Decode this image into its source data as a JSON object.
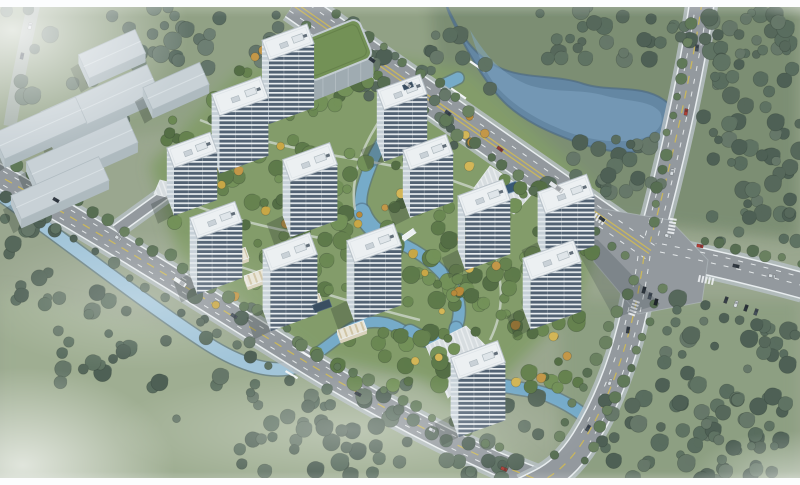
{
  "scene_title": "aerial-masterplan-rendering",
  "palette": {
    "base_grass": "#95a288",
    "asphalt": "#8d9398",
    "asphalt_hazy": "#a6aeb4",
    "sidewalk": "#b3bbc0",
    "curb": "#e9edef",
    "lane_yellow": "#cdb64a",
    "lane_white": "#eceff1",
    "lake": "#5b7f9e",
    "lake_light": "#7ba4c2",
    "water_edge": "#44627c",
    "canal_inner": "#6ea6c6",
    "canal_outer": "#9ec2d8",
    "roof_white": "#edf0f3",
    "roof_edge": "#b6bfc6",
    "warehouse_roof": "#c6cfd4",
    "warehouse_wall": "#aab6bc",
    "green_roof": "#6b8a4b",
    "green_roof_wall": "#9aa6ad",
    "shadow": "rgba(22,32,27,0.27)",
    "pool": "#2c4d6c"
  },
  "tree_palettes": {
    "F": [
      "#4c5e50",
      "#566a59",
      "#43564a",
      "#5d6f5f",
      "#4f6354"
    ],
    "FC": [
      "#5a6c60",
      "#4e6156",
      "#65776a"
    ],
    "I": [
      "#54713e",
      "#628047",
      "#4a6538",
      "#6b8a4e",
      "#5d7a43"
    ],
    "A": [
      "#c6a23a",
      "#d2b24c",
      "#b5832e",
      "#c1913c"
    ],
    "S": [
      "#57704e",
      "#4d6546",
      "#617956"
    ]
  },
  "fields": [
    {
      "pts": "0,0 800,0 800,165 430,150 260,120 0,150",
      "c": "#8b9b7d"
    },
    {
      "pts": "430,0 800,0 800,240 600,220 440,120",
      "c": "#74876a"
    },
    {
      "pts": "150,165 235,75 300,45 470,70 610,200 580,300 470,410 330,370 180,260",
      "c": "#7b9660"
    },
    {
      "pts": "0,290 420,380 560,485 0,485",
      "c": "#9aa98b"
    },
    {
      "pts": "560,300 800,300 800,485 560,485",
      "c": "#87997a"
    }
  ],
  "lake": {
    "body": "M446,4 C458,30 470,52 496,66 C522,80 556,74 584,84 C610,92 642,84 664,100 C684,114 688,134 668,144 C640,158 604,152 576,142 C548,132 522,120 504,102 C486,84 470,56 458,32 C452,20 448,12 446,4 Z",
    "highlight": "M470,30 C486,56 502,74 526,84 C552,94 580,88 606,96 C630,102 650,100 660,112 C666,124 656,136 636,140 C608,144 580,138 558,128 C534,118 512,104 498,88 C484,72 476,50 470,30 Z"
  },
  "canals": [
    {
      "d": "M-6,190 C60,236 140,300 208,344 C246,368 276,374 298,366",
      "w": 12,
      "c": "#9ec2d8"
    },
    {
      "d": "M298,366 C318,354 332,342 346,332 C362,320 382,318 402,330",
      "w": 10,
      "c": "#6ea6c6"
    },
    {
      "d": "M458,78 C434,90 414,96 403,112 C390,130 378,146 371,164 C364,182 358,198 362,212",
      "w": 11,
      "c": "#6ea6c6"
    },
    {
      "d": "M362,212 C368,228 382,238 398,242",
      "w": 16,
      "c": "#6ea6c6"
    },
    {
      "d": "M398,242 C420,252 436,264 448,280 C460,296 462,312 456,328",
      "w": 11,
      "c": "#6ea6c6"
    },
    {
      "d": "M456,328 C450,350 462,370 486,380 C510,390 532,388 550,396 C564,402 574,408 582,414",
      "w": 12,
      "c": "#6ea6c6"
    },
    {
      "d": "M410,332 C424,340 436,344 448,342",
      "w": 14,
      "c": "#6ea6c6"
    }
  ],
  "roads": [
    {
      "id": "hazy-northwest-road",
      "d": "M36,-6 C26,40 16,86 10,126",
      "w": 13,
      "hazy": true
    },
    {
      "id": "perimeter-south-road",
      "d": "M-8,172 C90,226 200,296 306,362 C378,406 440,438 498,464 C520,473 536,479 548,484",
      "w": 21
    },
    {
      "id": "east-exit-road",
      "d": "M660,252 C710,262 760,274 804,286",
      "w": 24
    },
    {
      "id": "north-vertical-road",
      "d": "M702,2 C690,84 668,176 650,242",
      "w": 23
    },
    {
      "id": "south-vertical-road",
      "d": "M644,256 C634,330 614,392 584,440 C570,462 556,474 540,482 L524,490",
      "w": 24
    },
    {
      "id": "main-diagonal-road",
      "d": "M294,4 L650,252",
      "w": 29
    },
    {
      "id": "west-gate-branch",
      "d": "M116,230 L174,188",
      "w": 9
    }
  ],
  "junction": {
    "pts": "585,206 670,220 708,260 702,302 638,314 594,262",
    "shadow_pts": "568,234 598,240 660,304 614,318"
  },
  "lane_marks": [
    {
      "d": "M293,5.5 L649,253.5",
      "t": "ys"
    },
    {
      "d": "M295,2.5 L651,250.5",
      "t": "ys"
    },
    {
      "d": "M289.4,10.6 L645.4,258.6",
      "t": "wd"
    },
    {
      "d": "M298.6,-2.6 L654.6,245.4",
      "t": "wd"
    },
    {
      "d": "M702,2 C690,84 668,176 650,242",
      "t": "yd"
    },
    {
      "d": "M696,2 C684,84 662,176 644,240",
      "t": "wd"
    },
    {
      "d": "M708,2 C696,84 674,176 656,244",
      "t": "wd"
    },
    {
      "d": "M644,256 C634,330 614,392 584,440 C570,462 556,474 540,482",
      "t": "yd"
    },
    {
      "d": "M638,256 C628,330 608,390 578,438",
      "t": "wd"
    },
    {
      "d": "M650,256 C640,330 620,394 590,442",
      "t": "wd"
    },
    {
      "d": "M-8,172 C90,226 200,296 306,362 C378,406 440,438 498,464 C520,473 536,479 548,484",
      "t": "yd"
    },
    {
      "d": "M-8,179 C90,233 200,303 306,369 C378,413 438,443 496,469",
      "t": "wd"
    },
    {
      "d": "M-8,165 C90,219 200,289 306,355 C378,399 442,431 500,457",
      "t": "wd"
    },
    {
      "d": "M660,252 C710,262 760,274 804,286",
      "t": "wd"
    },
    {
      "d": "M662,244 C712,254 762,266 804,278",
      "t": "wd"
    }
  ],
  "crosswalks": [
    {
      "x": 598,
      "y": 218,
      "a": 35
    },
    {
      "x": 672,
      "y": 226,
      "a": -80
    },
    {
      "x": 706,
      "y": 280,
      "a": 12
    },
    {
      "x": 634,
      "y": 308,
      "a": -70
    }
  ],
  "walkways": [
    "M200,120 C250,140 300,150 360,160 C420,170 460,180 500,200",
    "M180,200 C230,220 280,230 330,240",
    "M220,260 C280,280 340,300 420,320",
    "M480,230 C500,260 510,300 490,340",
    "M380,120 C360,150 350,180 355,210"
  ],
  "plazas": [
    {
      "pts": "490,166 532,194 514,214 474,188"
    },
    {
      "pts": "426,346 466,326 492,352 448,398"
    },
    {
      "pts": "160,180 184,186 178,200 154,194"
    }
  ],
  "pool": {
    "x": 505,
    "y": 190,
    "w": 26,
    "d": 9,
    "a": -20
  },
  "bridges": [
    {
      "kind": "road",
      "x": 468,
      "y": 80,
      "a": 35,
      "len": 18,
      "w": 31
    },
    {
      "kind": "road",
      "x": 298,
      "y": 364,
      "a": 31,
      "len": 14,
      "w": 23
    },
    {
      "kind": "ped",
      "x": 404,
      "y": 238,
      "a": -35,
      "len": 26,
      "w": 5
    },
    {
      "kind": "ped",
      "x": 348,
      "y": 331,
      "a": -25,
      "len": 18,
      "w": 4
    }
  ],
  "tree_regions": [
    [
      150,
      6,
      140,
      66,
      26,
      "FC"
    ],
    [
      345,
      16,
      95,
      84,
      22,
      "F"
    ],
    [
      535,
      6,
      255,
      54,
      55,
      "F"
    ],
    [
      700,
      52,
      100,
      165,
      48,
      "F"
    ],
    [
      545,
      136,
      118,
      62,
      26,
      "F"
    ],
    [
      432,
      28,
      60,
      120,
      14,
      "F"
    ],
    [
      708,
      212,
      92,
      34,
      10,
      "F"
    ],
    [
      660,
      298,
      140,
      182,
      52,
      "F"
    ],
    [
      600,
      393,
      200,
      88,
      42,
      "F"
    ],
    [
      238,
      383,
      305,
      96,
      68,
      "F"
    ],
    [
      58,
      288,
      195,
      132,
      34,
      "F"
    ],
    [
      0,
      178,
      66,
      132,
      16,
      "F"
    ],
    [
      0,
      6,
      145,
      150,
      20,
      "FC"
    ],
    [
      165,
      92,
      152,
      142,
      38,
      "I"
    ],
    [
      248,
      138,
      205,
      152,
      52,
      "I"
    ],
    [
      378,
      178,
      165,
      132,
      38,
      "I"
    ],
    [
      428,
      278,
      155,
      112,
      38,
      "I"
    ],
    [
      238,
      58,
      155,
      72,
      24,
      "I"
    ],
    [
      488,
      198,
      112,
      92,
      20,
      "I"
    ],
    [
      310,
      328,
      150,
      58,
      18,
      "I"
    ],
    [
      178,
      108,
      310,
      205,
      30,
      "A"
    ],
    [
      398,
      248,
      175,
      142,
      18,
      "A"
    ],
    [
      255,
      35,
      120,
      50,
      8,
      "A"
    ]
  ],
  "tree_lines": [
    [
      20,
      166,
      300,
      340,
      20,
      "S"
    ],
    [
      302,
      346,
      500,
      450,
      13,
      "S"
    ],
    [
      6,
      196,
      288,
      378,
      17,
      "F"
    ],
    [
      304,
      26,
      628,
      254,
      22,
      "S"
    ],
    [
      336,
      14,
      470,
      110,
      9,
      "S"
    ],
    [
      688,
      26,
      652,
      224,
      12,
      "S"
    ],
    [
      634,
      280,
      552,
      454,
      12,
      "S"
    ],
    [
      662,
      290,
      588,
      460,
      12,
      "S"
    ],
    [
      702,
      240,
      800,
      262,
      7,
      "S"
    ]
  ],
  "warehouses": [
    [
      112,
      54,
      62,
      26,
      9
    ],
    [
      100,
      102,
      116,
      30,
      10
    ],
    [
      176,
      86,
      62,
      24,
      9
    ],
    [
      40,
      128,
      90,
      28,
      9
    ],
    [
      82,
      152,
      110,
      28,
      10
    ],
    [
      60,
      188,
      96,
      26,
      9
    ]
  ],
  "green_roof_building": {
    "x": 334,
    "y": 50,
    "w": 68,
    "d": 42,
    "a": -22,
    "h": 20
  },
  "towers": [
    [
      288,
      42,
      48,
      21,
      64
    ],
    [
      402,
      92,
      46,
      21,
      52
    ],
    [
      240,
      96,
      52,
      23,
      58
    ],
    [
      192,
      150,
      46,
      21,
      48
    ],
    [
      428,
      152,
      46,
      21,
      48
    ],
    [
      310,
      162,
      50,
      23,
      56
    ],
    [
      566,
      194,
      52,
      23,
      50
    ],
    [
      484,
      198,
      48,
      22,
      54
    ],
    [
      216,
      220,
      48,
      22,
      56
    ],
    [
      374,
      243,
      50,
      23,
      60
    ],
    [
      290,
      252,
      50,
      23,
      60
    ],
    [
      552,
      260,
      54,
      23,
      50
    ],
    [
      478,
      360,
      50,
      23,
      58
    ]
  ],
  "tower_angle": -20,
  "retail_strips": [
    [
      232,
      258,
      32,
      11
    ],
    [
      260,
      276,
      30,
      11
    ],
    [
      306,
      304,
      32,
      11
    ],
    [
      352,
      330,
      28,
      10
    ],
    [
      470,
      404,
      34,
      11
    ]
  ],
  "solar_panels": [
    [
      322,
      306,
      18,
      8
    ],
    [
      408,
      86,
      10,
      5
    ]
  ],
  "cars": [
    [
      372,
      60,
      35,
      "#262e38"
    ],
    [
      408,
      85,
      35,
      "#d8dde1"
    ],
    [
      448,
      113,
      35,
      "#2f3a46"
    ],
    [
      500,
      149,
      35,
      "#8f2e28"
    ],
    [
      556,
      187,
      35,
      "#e2e6e9",
      15
    ],
    [
      602,
      219,
      35,
      "#262e38"
    ],
    [
      697,
      48,
      -84,
      "#39434f"
    ],
    [
      686,
      112,
      -81,
      "#a83228"
    ],
    [
      672,
      172,
      -78,
      "#d8dde1"
    ],
    [
      700,
      246,
      10,
      "#b03028"
    ],
    [
      668,
      236,
      20,
      "#d8dde1"
    ],
    [
      736,
      266,
      12,
      "#262e38"
    ],
    [
      772,
      276,
      12,
      "#d8dde1"
    ],
    [
      644,
      290,
      -75,
      "#1f2730"
    ],
    [
      650,
      296,
      -75,
      "#39434f"
    ],
    [
      656,
      302,
      -75,
      "#11161d"
    ],
    [
      726,
      300,
      -70,
      "#2a323c"
    ],
    [
      736,
      304,
      -70,
      "#d8dde1"
    ],
    [
      746,
      308,
      -70,
      "#1f2730"
    ],
    [
      756,
      312,
      -70,
      "#39434f"
    ],
    [
      628,
      330,
      -82,
      "#262e38"
    ],
    [
      610,
      382,
      -72,
      "#d8dde1"
    ],
    [
      588,
      428,
      -60,
      "#39434f"
    ],
    [
      56,
      200,
      30,
      "#262e38"
    ],
    [
      118,
      238,
      32,
      "#d8dde1"
    ],
    [
      180,
      282,
      33,
      "#eceff1",
      14
    ],
    [
      234,
      316,
      33,
      "#39434f"
    ],
    [
      358,
      394,
      28,
      "#262e38"
    ],
    [
      432,
      430,
      26,
      "#d8dde1"
    ],
    [
      504,
      469,
      22,
      "#a83228"
    ],
    [
      22,
      56,
      -78,
      "#39434f"
    ],
    [
      30,
      26,
      -77,
      "#d8dde1"
    ]
  ],
  "frame": {
    "top_h": 7,
    "bottom_h": 7
  }
}
